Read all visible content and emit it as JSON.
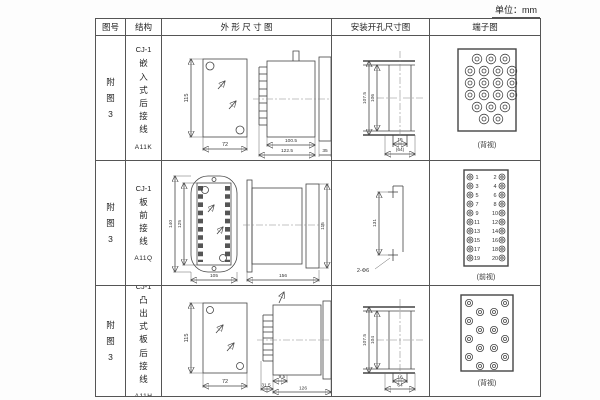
{
  "page": {
    "unit_label": "单位：mm"
  },
  "table": {
    "headers": {
      "fig": "图号",
      "structure": "结构",
      "outline": "外 形 尺 寸 图",
      "install": "安装开孔尺寸图",
      "terminal": "端子图"
    }
  },
  "rows": [
    {
      "fig_no": "附图3",
      "structure": {
        "model": "CJ-1",
        "mount": "嵌入式后接线",
        "code": "A11K"
      },
      "outline": {
        "front_h": "115",
        "front_w": "72",
        "body": "100.5",
        "total": "122.5",
        "flange": "35"
      },
      "install": {
        "outer": "107.5",
        "inner": "106",
        "small": "16",
        "bracket": "(64)"
      },
      "terminal": {
        "view": "(背视)"
      }
    },
    {
      "fig_no": "附图3",
      "structure": {
        "model": "CJ-1",
        "mount": "板前接线",
        "code": "A11Q"
      },
      "outline": {
        "outer_h": "140",
        "inner_h": "125",
        "front_w": "105",
        "body_l": "156",
        "body_h": "115"
      },
      "install": {
        "span": "131",
        "holes": "2-Φ6"
      },
      "terminal": {
        "view": "(前视)",
        "pairs": [
          [
            "1",
            "2"
          ],
          [
            "3",
            "4"
          ],
          [
            "5",
            "6"
          ],
          [
            "7",
            "8"
          ],
          [
            "9",
            "10"
          ],
          [
            "11",
            "12"
          ],
          [
            "13",
            "14"
          ],
          [
            "15",
            "16"
          ],
          [
            "17",
            "18"
          ],
          [
            "19",
            "20"
          ]
        ]
      }
    },
    {
      "fig_no": "附图3",
      "structure": {
        "model": "CJ-1",
        "mount": "凸出式板后接线",
        "code": "A11H"
      },
      "outline": {
        "front_h": "115",
        "front_w": "72",
        "comb": "31.5",
        "offset": "9.5",
        "total": "126"
      },
      "install": {
        "outer": "107.5",
        "inner": "104",
        "small": "16",
        "bracket": "64"
      },
      "terminal": {
        "view": "(背视)"
      }
    }
  ]
}
